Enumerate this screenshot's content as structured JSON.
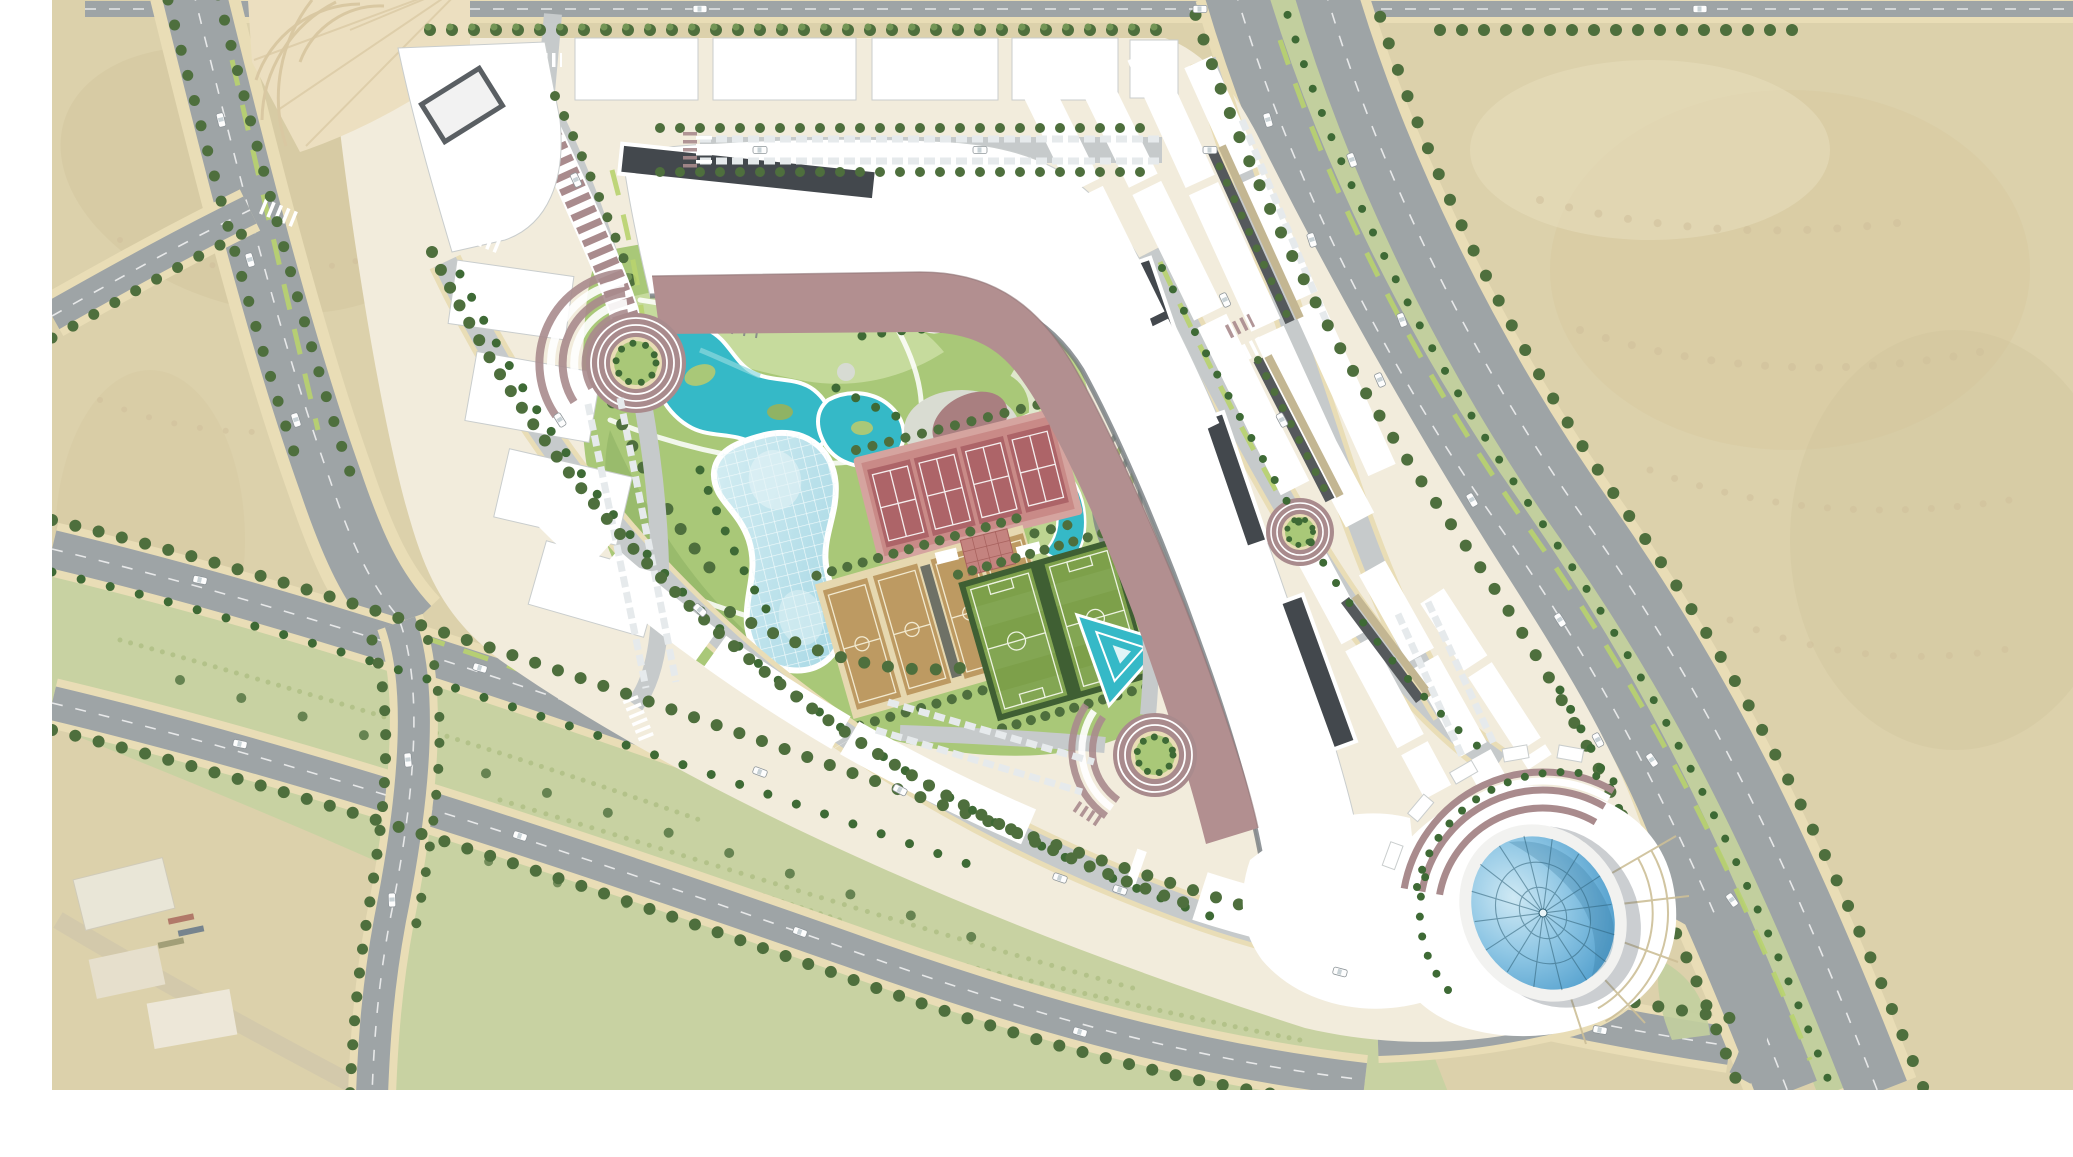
{
  "document": {
    "type": "architectural-masterplan-aerial-rendering",
    "description": "Top-down aerial rendering of a triangular mixed-use development surrounded by desert and highways, with a central sports park, curved mall building with rose-colored ramp, perimeter housing rows and a blue glass dome at the south-east tip",
    "visible_text": "none"
  },
  "palette": {
    "sand": "#dcd1ab",
    "sandDark": "#cfc29a",
    "scrub": "#c8d2a2",
    "scrubDot": "#a9ba7f",
    "road": "#9ea4a6",
    "roadLight": "#c6cacb",
    "sidewalk": "#e9ddb6",
    "curb": "#cdbf97",
    "grassBright": "#b8d36e",
    "medianGreen": "#c2cf9e",
    "treeDark": "#4e6f3d",
    "treeLight": "#729555",
    "palm": "#3e6a35",
    "bldg": "#ffffff",
    "bldgShadow": "#9aa2a4",
    "skylight": "#43484d",
    "pinkRoof": "#b28f90",
    "mauve": "#a98b8d",
    "plazaTan": "#d9c8a2",
    "plazaBase": "#ecdfc0",
    "lawn": "#a9c878",
    "lawnLight": "#cde0a6",
    "lawnDark": "#8fb364",
    "pool": "#35b9c7",
    "poolLight": "#8fd8de",
    "glassPool": "#b8dfe8",
    "domeLight": "#9fd0e8",
    "domeDark": "#4e9fce",
    "domeRib": "#2f6076",
    "tennisCourt": "#ad6468",
    "tennisFrame": "#c98a87",
    "tennisSurround": "#d5a49f",
    "bballCourt": "#bd9a62",
    "bballGap": "#e6d8b0",
    "soccer": "#7da04a",
    "hedge": "#3f5f33",
    "stage": "#a97f80",
    "terraceGreen": "#cfe3a0",
    "terraceLight": "#eef3e2",
    "carportDark": "#55595c",
    "carportTan": "#c3b692",
    "margin": "#ffffff"
  },
  "features": {
    "desert": "Sand desert with dune texture surrounding the site",
    "highways": "Tree-lined multi-lane highways crossing the desert on the west, south and east sides",
    "site": "Triangular development parcel bounded by highways",
    "mall_complex": "Large curved white mall building with dark linear skylights",
    "pink_ramp": "Dusty-rose roof/ramp band following the inner edge of the mall",
    "park": "Central landscaped park with pools, lawns and sports facilities",
    "lazy_river": "Organic turquoise lazy-river pools with green islands",
    "wave_pool_canopy": "Organically shaped pale-blue glass canopy pool with lattice grid",
    "amphitheatre": "Semi-circular terraced lawn amphitheatre with rose-colored stage",
    "triangular_pool": "Triangular turquoise water feature with concentric white edges",
    "cascade": "Stepped turquoise water cascade with terraced garden arcs",
    "glass_dome": "Elliptical blue glass dome with radial ribs at the south-east tip",
    "roundabouts": "Concentric mauve-and-white ringed roundabouts with green centres",
    "housing_rows": "White row-building strips with beige garden strips and covered parking",
    "playgrounds": "Circular playgrounds with colorful equipment dots",
    "industrial": "Faded industrial sheds in the south-west desert corner"
  },
  "counts": {
    "tennis_courts": 4,
    "basketball_courts": 4,
    "football_pitches": 2,
    "roundabouts": 3,
    "glass_domes": 1,
    "amphitheatres": 1,
    "playground_circles": 2,
    "skylight_strips": 4
  }
}
